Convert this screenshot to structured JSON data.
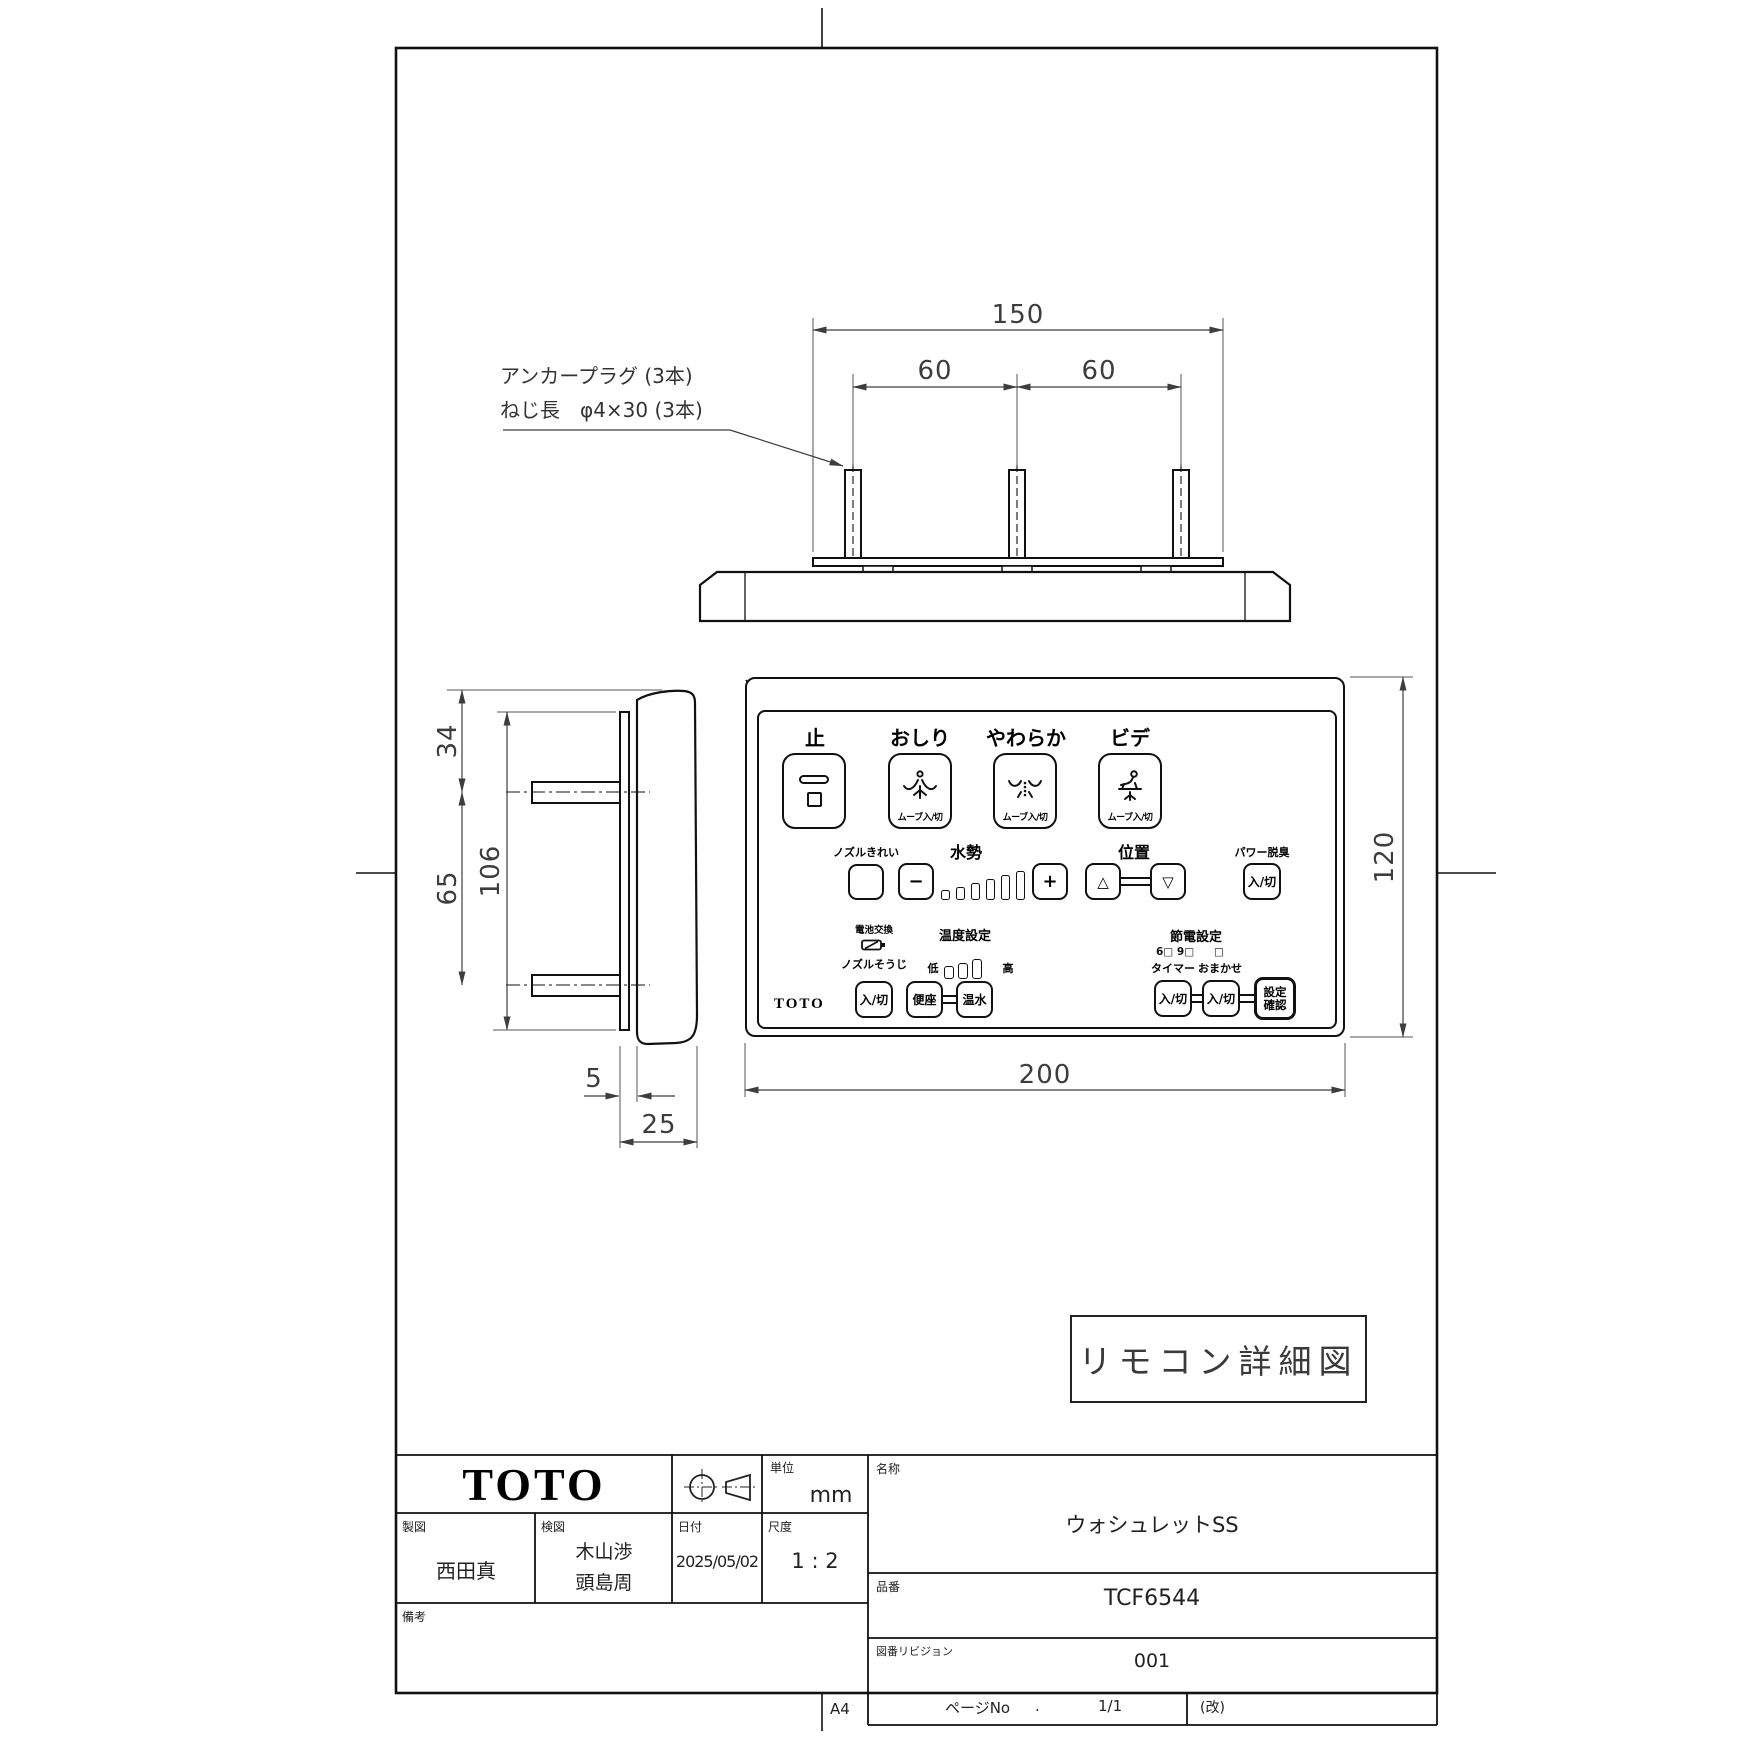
{
  "sheet": {
    "format": "A4"
  },
  "stamp": {
    "text": "リモコン詳細図"
  },
  "top_view": {
    "note_line1": "アンカープラグ (3本)",
    "note_line2": "ねじ長　φ4×30 (3本)",
    "dim_overall": "150",
    "dim_pitch_left": "60",
    "dim_pitch_right": "60"
  },
  "side_view": {
    "dim_top_offset": "34",
    "dim_screw_pitch": "65",
    "dim_plate_height": "106",
    "dim_plate_thickness": "5",
    "dim_depth": "25"
  },
  "front_view": {
    "dim_height": "120",
    "dim_width": "200"
  },
  "remote": {
    "brand": "TOTO",
    "stop": {
      "label": "止"
    },
    "oshiri": {
      "label": "おしり",
      "sub": "ムーブ入/切"
    },
    "soft": {
      "label": "やわらか",
      "sub": "ムーブ入/切"
    },
    "bidet": {
      "label": "ビデ",
      "sub": "ムーブ入/切"
    },
    "nozzle_clean": {
      "label": "ノズルきれい"
    },
    "water_pressure": {
      "label": "水勢",
      "minus": "−",
      "plus": "+"
    },
    "position": {
      "label": "位置",
      "up": "△",
      "down": "▽"
    },
    "deodorizer": {
      "label": "パワー脱臭",
      "button": "入/切"
    },
    "battery": {
      "label": "電池交換"
    },
    "nozzle_wash": {
      "label": "ノズルそうじ",
      "button": "入/切"
    },
    "temperature": {
      "label": "温度設定",
      "low": "低",
      "high": "高",
      "seat": "便座",
      "water": "温水"
    },
    "energy": {
      "label": "節電設定",
      "indicators": "6□ 9□",
      "indicator_right": "□",
      "timer": "タイマー",
      "auto": "おまかせ",
      "button1": "入/切",
      "button2": "入/切",
      "confirm_line1": "設定",
      "confirm_line2": "確認"
    }
  },
  "title_block": {
    "brand": "TOTO",
    "unit": {
      "label": "単位",
      "value": "mm"
    },
    "drafter": {
      "label": "製図",
      "value": "西田真"
    },
    "checker": {
      "label": "検図",
      "value1": "木山渉",
      "value2": "頭島周"
    },
    "date": {
      "label": "日付",
      "value": "2025/05/02"
    },
    "scale": {
      "label": "尺度",
      "value": "1 : 2"
    },
    "remarks": {
      "label": "備考"
    },
    "name": {
      "label": "名称",
      "value": "ウォシュレットSS"
    },
    "part_no": {
      "label": "品番",
      "value": "TCF6544"
    },
    "revision": {
      "label": "図番リビジョン",
      "value": "001"
    },
    "page": {
      "label": "ページNo",
      "dot": ".",
      "value": "1/1",
      "rev_mark": "(改)"
    }
  }
}
